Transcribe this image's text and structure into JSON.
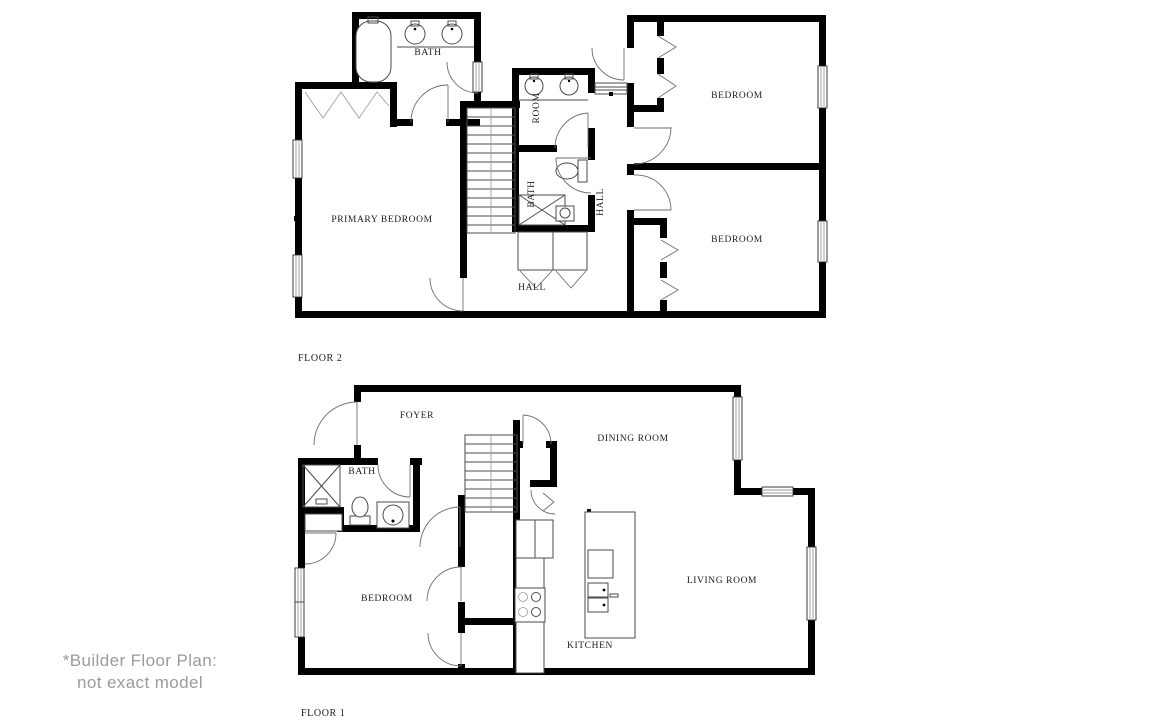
{
  "disclaimer": {
    "line1": "*Builder Floor Plan:",
    "line2": "not exact model"
  },
  "colors": {
    "wall": "#000000",
    "line": "#4b4b4b",
    "label": "#1b1b1b",
    "disclaimer": "#9b9b9b"
  },
  "floor2": {
    "label": "FLOOR 2",
    "rooms": {
      "bath_top": "BATH",
      "primary_bedroom": "PRIMARY BEDROOM",
      "room": "ROOM",
      "bath_middle": "BATH",
      "hall_upper": "HALL",
      "hall_lower": "HALL",
      "bedroom_top": "BEDROOM",
      "bedroom_bottom": "BEDROOM"
    }
  },
  "floor1": {
    "label": "FLOOR 1",
    "rooms": {
      "foyer": "FOYER",
      "dining_room": "DINING ROOM",
      "bath": "BATH",
      "bedroom": "BEDROOM",
      "kitchen": "KITCHEN",
      "living_room": "LIVING ROOM"
    }
  }
}
